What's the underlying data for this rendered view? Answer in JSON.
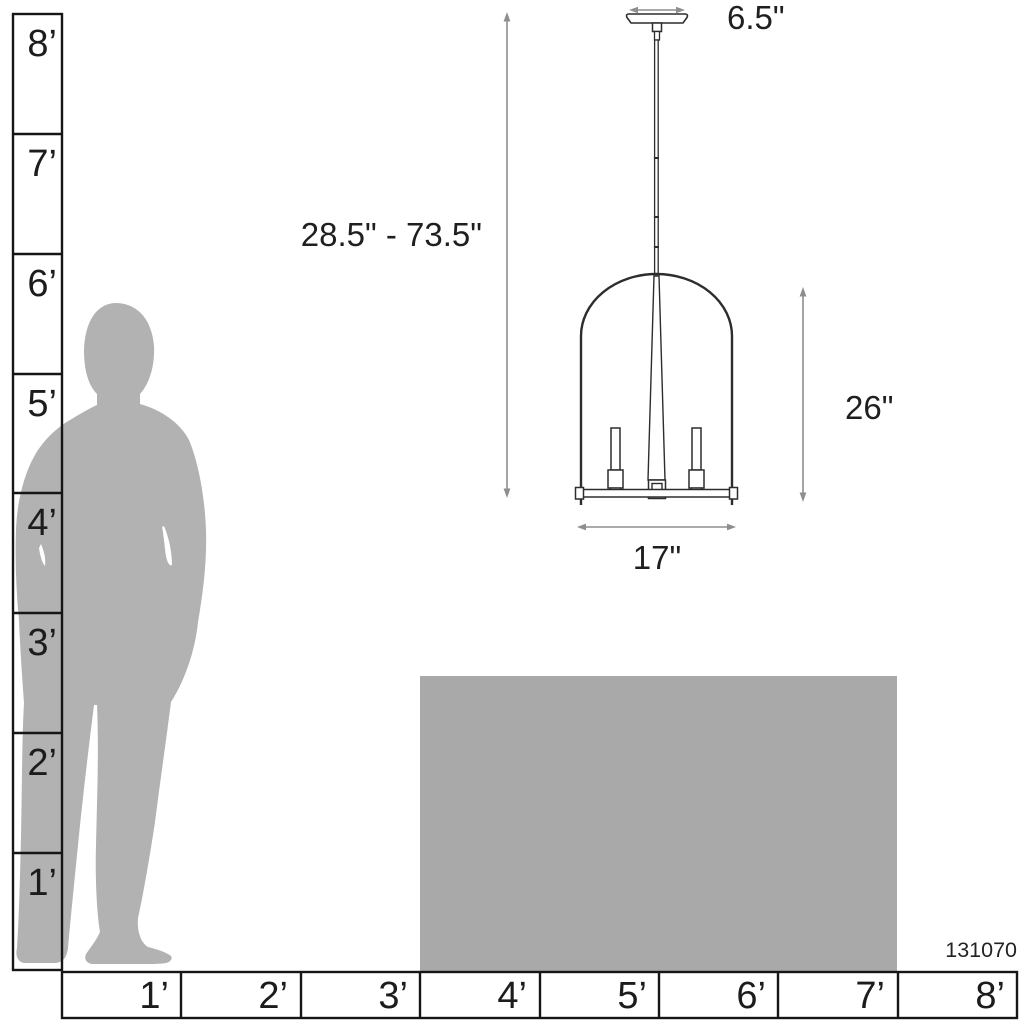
{
  "diagram": {
    "product_code": "131070",
    "dimensions": {
      "canopy_width": "6.5\"",
      "hanging_height_range": "28.5\" - 73.5\"",
      "fixture_height": "26\"",
      "fixture_width": "17\""
    },
    "vertical_ruler": {
      "labels": [
        "8’",
        "7’",
        "6’",
        "5’",
        "4’",
        "3’",
        "2’",
        "1’"
      ]
    },
    "horizontal_ruler": {
      "labels": [
        "1’",
        "2’",
        "3’",
        "4’",
        "5’",
        "6’",
        "7’",
        "8’"
      ]
    },
    "colors": {
      "silhouette": "#b2b2b2",
      "table": "#a9a9a9",
      "ruler_line": "#161616",
      "fixture_line": "#2d2d2d",
      "dimension_line": "#8e8e8e"
    }
  }
}
